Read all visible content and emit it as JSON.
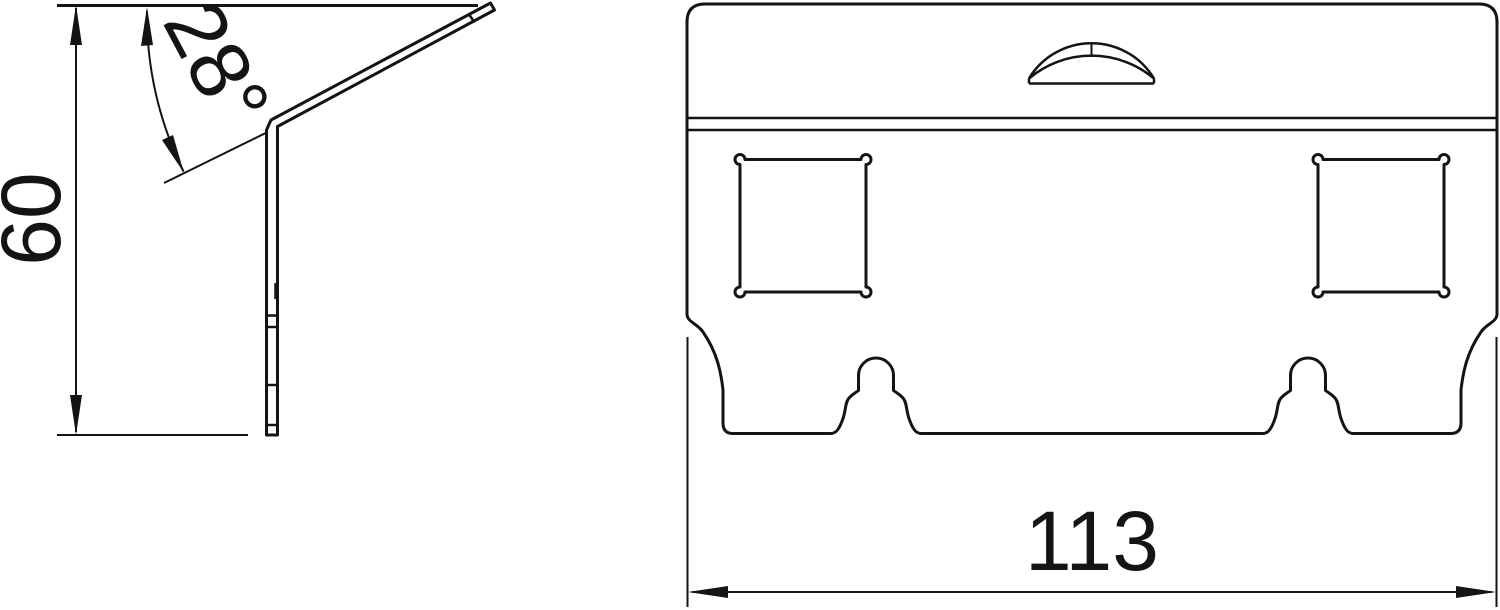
{
  "drawing": {
    "kind": "technical-drawing",
    "background_color": "#ffffff",
    "line_color": "#141414",
    "dimensions": {
      "height": {
        "value": "60"
      },
      "angle": {
        "value": "28°"
      },
      "width": {
        "value": "113"
      }
    }
  }
}
